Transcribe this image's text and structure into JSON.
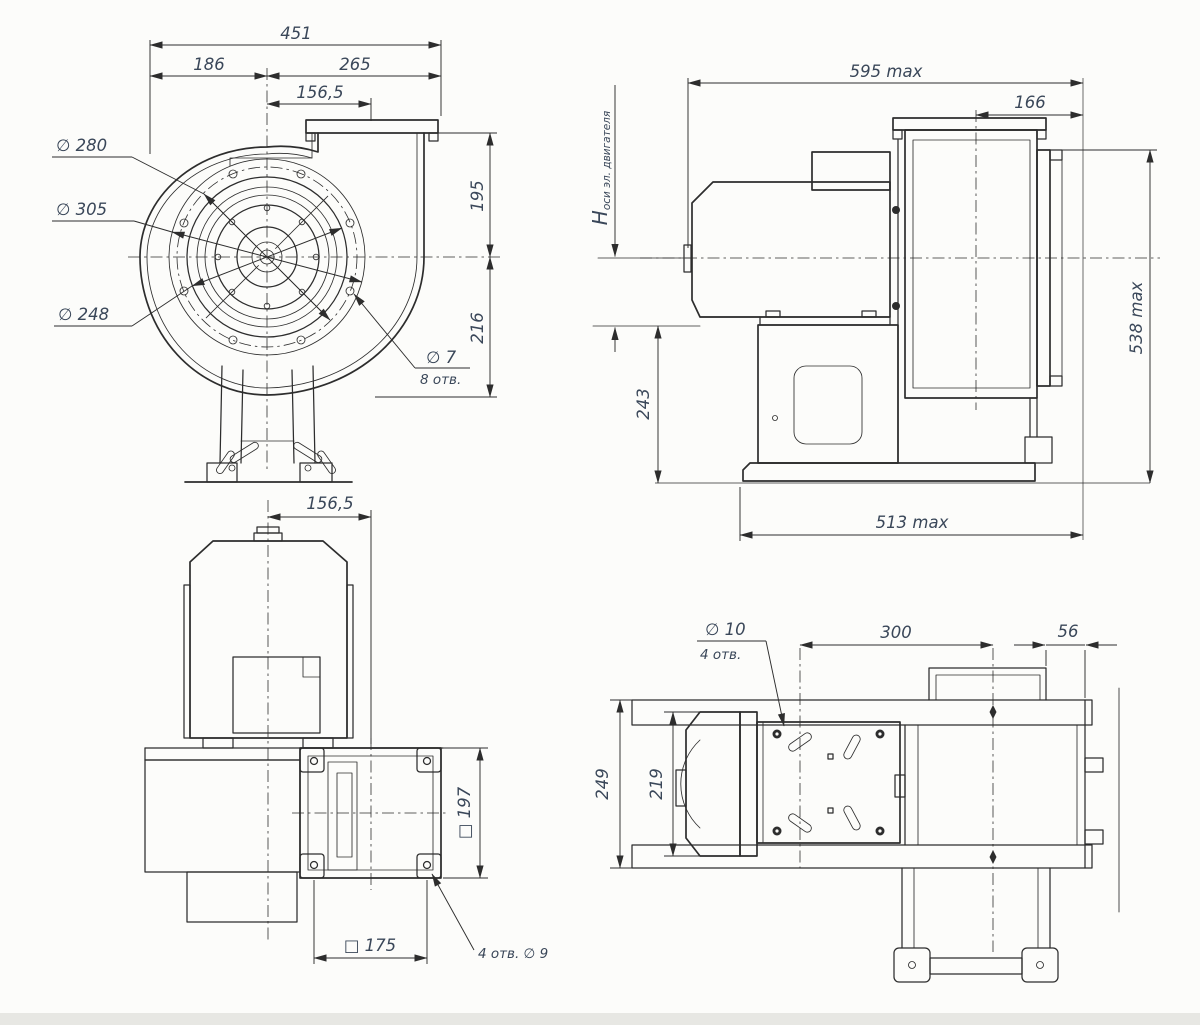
{
  "colors": {
    "background": "#fcfcfa",
    "line": "#2d2d2d",
    "dim_text": "#3a4759",
    "page_edge": "#e7e7e3"
  },
  "front_view": {
    "overall_width": "451",
    "width_left": "186",
    "width_right": "265",
    "outlet_offset": "156,5",
    "height_above_axis": "195",
    "height_below_axis": "216",
    "bolt_circle_dia": "∅ 280",
    "flange_outer_dia": "∅ 305",
    "inlet_dia": "∅ 248",
    "hole_dia": "∅ 7",
    "hole_count": "8 отв."
  },
  "side_view": {
    "overall_length": "595 max",
    "collar_depth": "166",
    "axis_symbol": "H",
    "axis_label": "оси эл. двигателя",
    "pedestal_height": "243",
    "base_length": "513 max",
    "overall_height": "538 max"
  },
  "bottom_view": {
    "outlet_offset": "156,5",
    "flange_square": "□ 197",
    "bolt_square": "□ 175",
    "hole_note": "4 отв.  ∅ 9"
  },
  "top_view": {
    "hole_dia": "∅ 10",
    "hole_count": "4 отв.",
    "hole_pitch": "300",
    "overhang": "56",
    "frame_width": "249",
    "mount_width": "219"
  }
}
